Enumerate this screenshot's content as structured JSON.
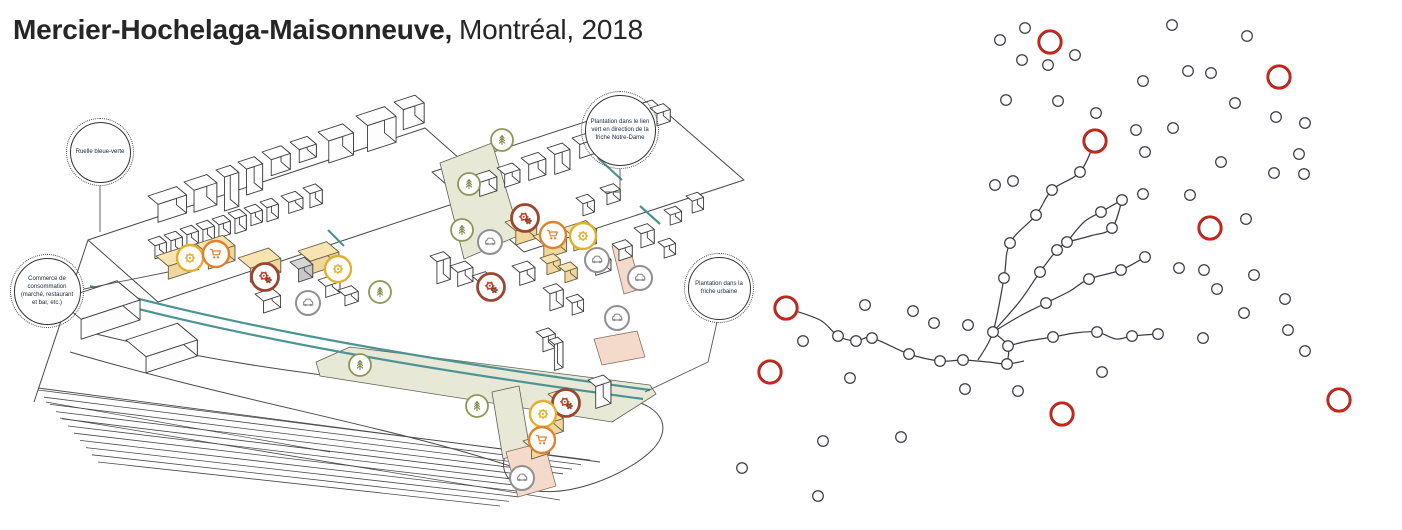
{
  "title": {
    "bold": "Mercier-Hochelaga-Maisonneuve,",
    "regular": "Montréal, 2018"
  },
  "callouts": [
    {
      "id": "ruelle-bleue-verte",
      "label": "Ruelle bleue-verte"
    },
    {
      "id": "commerce-consommation",
      "label": "Commerce de consommation (marché, restaurant et bar, etc.)"
    },
    {
      "id": "plantation-lien-vert",
      "label": "Plantation dans le lien vert en direction de la friche Notre-Dame"
    },
    {
      "id": "plantation-friche-urbaine",
      "label": "Plantation dans la friche urbaine"
    }
  ],
  "colors": {
    "teal": "#4e9394",
    "accent_red": "#cf2318",
    "node_stroke": "#3d3d46",
    "building_tan": "#f7e4b0",
    "green_area": "#e7e9d6",
    "pink_area": "#f3dacb",
    "icon_orange": "#e0812f",
    "icon_red": "#c23a22",
    "icon_red_ring": "#9c4632",
    "icon_yellow": "#e3b02d",
    "icon_olive": "#8f9655",
    "icon_gray": "#909090"
  },
  "map": {
    "icons": [
      {
        "type": "gear-yellow",
        "x": 190,
        "y": 258
      },
      {
        "type": "shopping-cart",
        "x": 216,
        "y": 254
      },
      {
        "type": "gears-red",
        "x": 265,
        "y": 277
      },
      {
        "type": "gear-yellow",
        "x": 338,
        "y": 269
      },
      {
        "type": "car",
        "x": 308,
        "y": 303
      },
      {
        "type": "gears-red",
        "x": 525,
        "y": 218
      },
      {
        "type": "shopping-cart",
        "x": 553,
        "y": 235
      },
      {
        "type": "gear-yellow",
        "x": 583,
        "y": 236
      },
      {
        "type": "car",
        "x": 490,
        "y": 242
      },
      {
        "type": "car",
        "x": 597,
        "y": 260
      },
      {
        "type": "car",
        "x": 640,
        "y": 278
      },
      {
        "type": "car",
        "x": 617,
        "y": 318
      },
      {
        "type": "gears-red",
        "x": 491,
        "y": 287
      },
      {
        "type": "tree",
        "x": 502,
        "y": 140
      },
      {
        "type": "tree",
        "x": 469,
        "y": 184
      },
      {
        "type": "tree",
        "x": 462,
        "y": 230
      },
      {
        "type": "tree",
        "x": 380,
        "y": 292
      },
      {
        "type": "tree",
        "x": 360,
        "y": 365
      },
      {
        "type": "tree",
        "x": 477,
        "y": 406
      },
      {
        "type": "gears-red",
        "x": 566,
        "y": 403
      },
      {
        "type": "gear-yellow",
        "x": 543,
        "y": 414
      },
      {
        "type": "shopping-cart",
        "x": 542,
        "y": 440
      },
      {
        "type": "car",
        "x": 522,
        "y": 478
      }
    ]
  },
  "network": {
    "red_nodes": [
      [
        786,
        308
      ],
      [
        770,
        372
      ],
      [
        1050,
        42
      ],
      [
        1095,
        141
      ],
      [
        1279,
        77
      ],
      [
        1210,
        228
      ],
      [
        1062,
        414
      ],
      [
        1339,
        400
      ]
    ],
    "edges": [
      [
        [
          786,
          308
        ],
        [
          820,
          320
        ],
        [
          838,
          336
        ],
        [
          856,
          341
        ],
        [
          872,
          338
        ],
        [
          909,
          354
        ],
        [
          940,
          361
        ],
        [
          963,
          360
        ],
        [
          988,
          362
        ],
        [
          1007,
          364
        ],
        [
          1024,
          361
        ]
      ],
      [
        [
          978,
          360
        ],
        [
          993,
          332
        ],
        [
          1004,
          278
        ],
        [
          1010,
          243
        ],
        [
          1036,
          215
        ],
        [
          1052,
          190
        ],
        [
          1080,
          172
        ],
        [
          1095,
          141
        ]
      ],
      [
        [
          993,
          332
        ],
        [
          1008,
          346
        ],
        [
          1007,
          364
        ]
      ],
      [
        [
          993,
          332
        ],
        [
          1020,
          301
        ],
        [
          1040,
          272
        ],
        [
          1057,
          250
        ],
        [
          1067,
          242
        ]
      ],
      [
        [
          1067,
          242
        ],
        [
          1084,
          222
        ],
        [
          1101,
          212
        ],
        [
          1122,
          200
        ]
      ],
      [
        [
          1067,
          242
        ],
        [
          1090,
          236
        ],
        [
          1112,
          228
        ],
        [
          1122,
          200
        ]
      ],
      [
        [
          993,
          332
        ],
        [
          1020,
          316
        ],
        [
          1046,
          303
        ],
        [
          1070,
          291
        ],
        [
          1089,
          279
        ],
        [
          1121,
          270
        ],
        [
          1145,
          257
        ]
      ],
      [
        [
          1008,
          346
        ],
        [
          1028,
          341
        ],
        [
          1053,
          337
        ],
        [
          1075,
          333
        ],
        [
          1097,
          332
        ],
        [
          1116,
          339
        ],
        [
          1132,
          336
        ],
        [
          1158,
          334
        ]
      ]
    ],
    "beads": [
      [
        838,
        336
      ],
      [
        856,
        341
      ],
      [
        872,
        338
      ],
      [
        909,
        354
      ],
      [
        940,
        361
      ],
      [
        963,
        360
      ],
      [
        1007,
        364
      ],
      [
        993,
        332
      ],
      [
        1004,
        278
      ],
      [
        1010,
        243
      ],
      [
        1036,
        215
      ],
      [
        1052,
        190
      ],
      [
        1080,
        172
      ],
      [
        1008,
        346
      ],
      [
        1040,
        272
      ],
      [
        1057,
        250
      ],
      [
        1067,
        242
      ],
      [
        1101,
        212
      ],
      [
        1122,
        200
      ],
      [
        1112,
        228
      ],
      [
        1046,
        303
      ],
      [
        1089,
        279
      ],
      [
        1121,
        270
      ],
      [
        1145,
        257
      ],
      [
        1053,
        337
      ],
      [
        1097,
        332
      ],
      [
        1132,
        336
      ],
      [
        1158,
        334
      ]
    ],
    "scatter": [
      [
        803,
        341
      ],
      [
        850,
        378
      ],
      [
        865,
        305
      ],
      [
        913,
        311
      ],
      [
        934,
        323
      ],
      [
        968,
        325
      ],
      [
        823,
        441
      ],
      [
        901,
        437
      ],
      [
        818,
        496
      ],
      [
        742,
        468
      ],
      [
        965,
        389
      ],
      [
        1018,
        391
      ],
      [
        1000,
        40
      ],
      [
        1025,
        28
      ],
      [
        1022,
        60
      ],
      [
        1048,
        65
      ],
      [
        1075,
        55
      ],
      [
        1006,
        100
      ],
      [
        1058,
        101
      ],
      [
        1096,
        113
      ],
      [
        995,
        185
      ],
      [
        1013,
        181
      ],
      [
        1172,
        25
      ],
      [
        1247,
        36
      ],
      [
        1143,
        81
      ],
      [
        1188,
        71
      ],
      [
        1211,
        73
      ],
      [
        1235,
        103
      ],
      [
        1276,
        117
      ],
      [
        1305,
        123
      ],
      [
        1136,
        130
      ],
      [
        1173,
        128
      ],
      [
        1145,
        152
      ],
      [
        1221,
        162
      ],
      [
        1299,
        154
      ],
      [
        1274,
        173
      ],
      [
        1304,
        174
      ],
      [
        1143,
        194
      ],
      [
        1190,
        195
      ],
      [
        1246,
        219
      ],
      [
        1179,
        268
      ],
      [
        1204,
        270
      ],
      [
        1254,
        275
      ],
      [
        1217,
        289
      ],
      [
        1285,
        299
      ],
      [
        1244,
        313
      ],
      [
        1203,
        338
      ],
      [
        1288,
        330
      ],
      [
        1305,
        351
      ],
      [
        1102,
        372
      ]
    ]
  }
}
